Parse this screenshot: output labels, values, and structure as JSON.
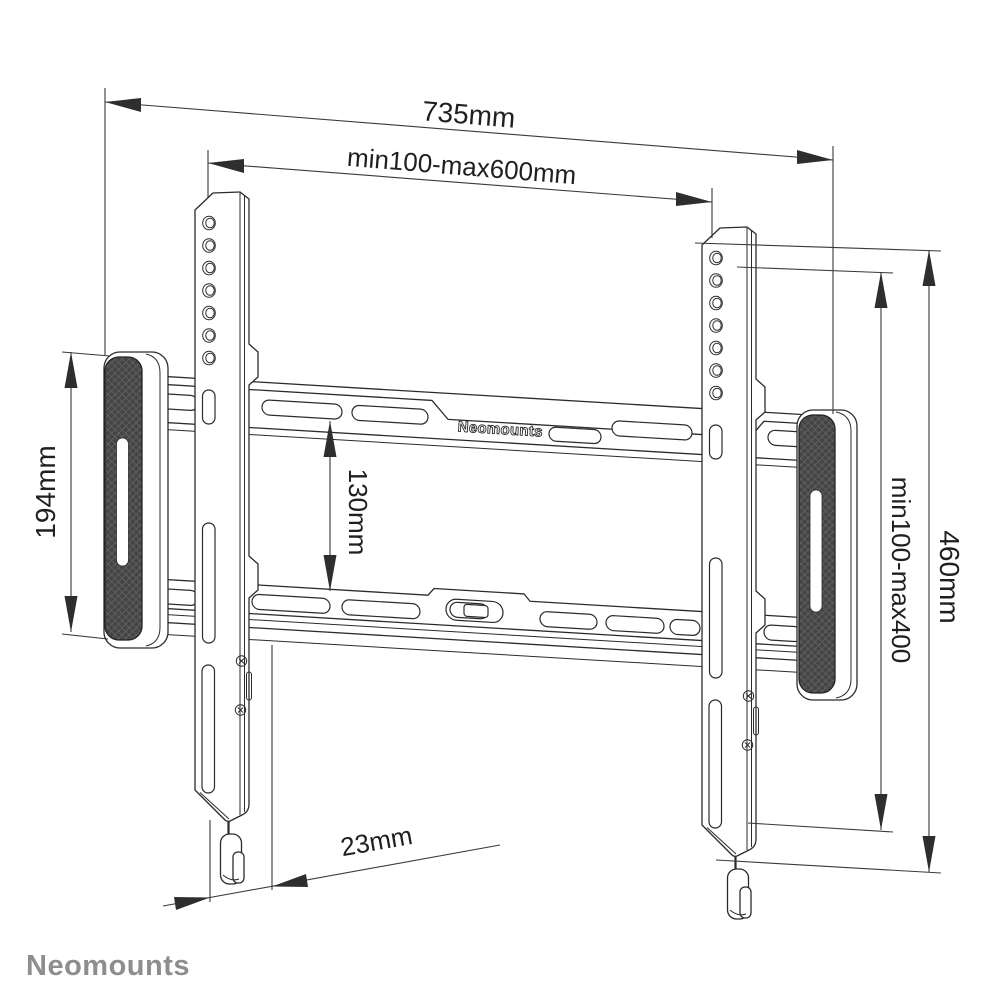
{
  "drawing": {
    "dim_total_width": "735mm",
    "dim_vesa_width": "min100-max600mm",
    "dim_pad_height": "194mm",
    "dim_rail_gap": "130mm",
    "dim_vesa_height": "min100-max400",
    "dim_bracket_height": "460mm",
    "dim_depth": "23mm",
    "plate_logo": "Neomounts"
  },
  "footer": {
    "brand": "Neomounts"
  }
}
